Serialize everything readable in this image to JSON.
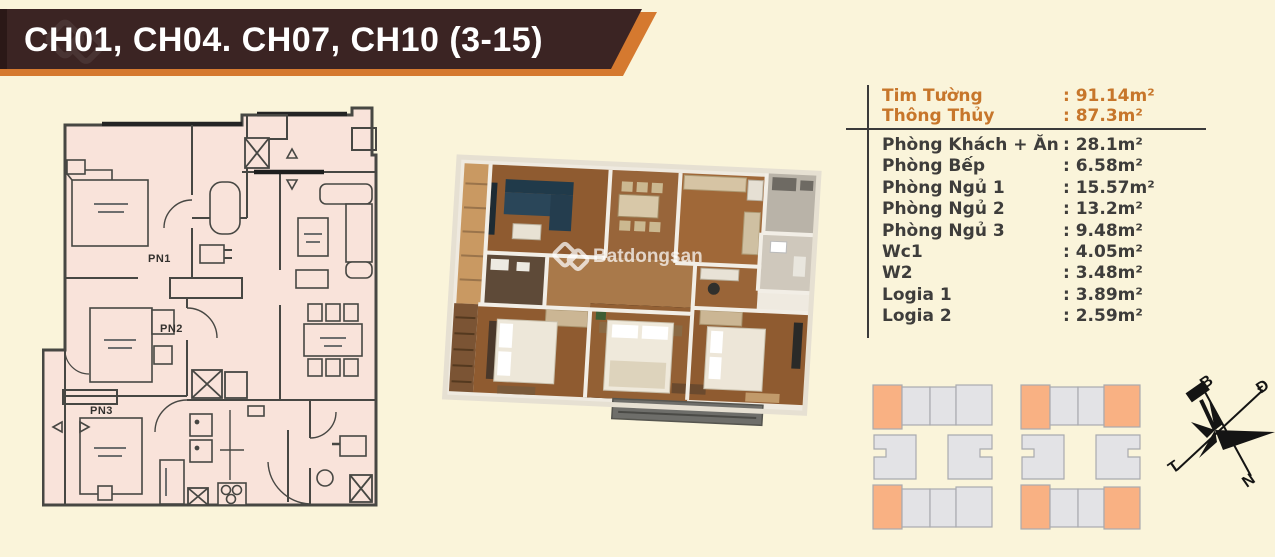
{
  "title": "CH01, CH04. CH07, CH10 (3-15)",
  "watermark": "Batdongsan",
  "area_table": {
    "summary_rows": [
      {
        "label": "Tim Tường",
        "area": ": 91.14m²"
      },
      {
        "label": "Thông Thủy",
        "area": ": 87.3m²"
      }
    ],
    "room_rows": [
      {
        "label": "Phòng Khách + Ăn",
        "area": ": 28.1m²"
      },
      {
        "label": "Phòng Bếp",
        "area": ": 6.58m²"
      },
      {
        "label": "Phòng Ngủ 1",
        "area": ": 15.57m²"
      },
      {
        "label": "Phòng Ngủ 2",
        "area": ": 13.2m²"
      },
      {
        "label": "Phòng Ngủ 3",
        "area": ": 9.48m²"
      },
      {
        "label": "Wc1",
        "area": ": 4.05m²"
      },
      {
        "label": "W2",
        "area": ": 3.48m²"
      },
      {
        "label": "Logia 1",
        "area": ": 3.89m²"
      },
      {
        "label": "Logia 2",
        "area": ": 2.59m²"
      }
    ]
  },
  "floorplan": {
    "bedroom_labels": [
      "PN1",
      "PN2",
      "PN3"
    ]
  },
  "compass": {
    "north_label": "B",
    "east_label": "Đ",
    "west_label": "T",
    "south_label": "N"
  },
  "colors": {
    "background": "#FAF4DA",
    "banner_brown": "#3B2423",
    "accent_orange": "#D5792F",
    "table_orange": "#C7762B",
    "table_text": "#3E3D3B",
    "plan_fill": "#F9E3DA",
    "plan_wall": "#474743",
    "keyplan_highlight": "#F9B183",
    "keyplan_gray": "#E3E3E6"
  }
}
